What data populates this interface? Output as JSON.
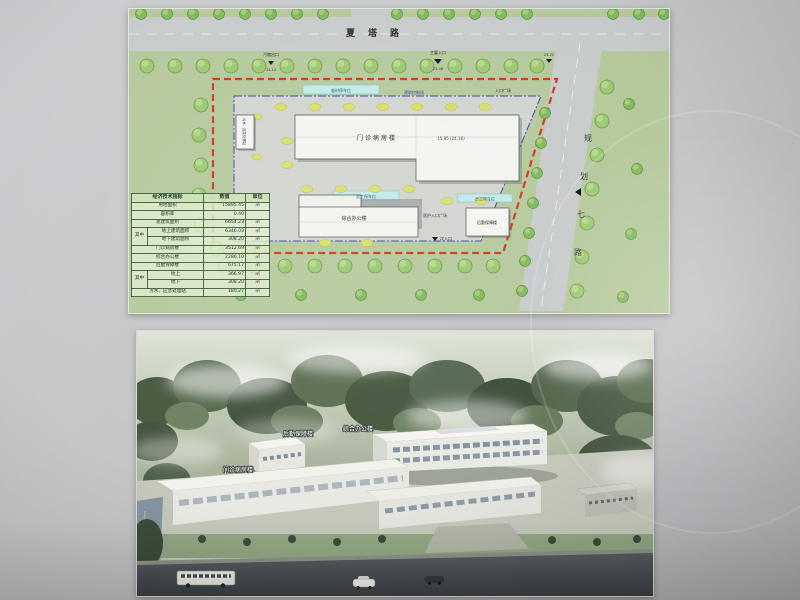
{
  "plan": {
    "road_top": "夏塔路",
    "road_right_chars": [
      "规",
      "划",
      "七",
      "路"
    ],
    "entrances": [
      {
        "label": "污物出口",
        "elev": "23.14"
      },
      {
        "label": "主要入口",
        "elev": "23.46"
      },
      {
        "label": "",
        "elev": "23.22"
      }
    ],
    "labels": {
      "temp_parking": "临时停车位",
      "setback_line": "建筑控制线",
      "entry_plaza": "入口广场",
      "staff_parking": "员工停车位",
      "staff_parking2": "员工停车位",
      "nurse_plaza": "医护入口广场",
      "secondary_entrance": "次入口"
    },
    "buildings": {
      "ward": {
        "name": "门诊病房楼",
        "elev": "15.95 (24.16)"
      },
      "office": {
        "name": "综合办公楼"
      },
      "logistics": {
        "name": "后勤保障楼"
      },
      "sewage": {
        "name": "污水、应急处理站"
      }
    },
    "table": {
      "title": "经济技术指标",
      "col_value": "数值",
      "col_unit": "单位",
      "group_label": "其中",
      "rows": [
        {
          "name": "用地面积",
          "value": "15895.45",
          "unit": "㎡"
        },
        {
          "name": "容积率",
          "value": "0.40",
          "unit": ""
        },
        {
          "name": "总建筑面积",
          "value": "6654.23",
          "unit": "㎡"
        },
        {
          "name": "地上建筑面积",
          "value": "6346.03",
          "unit": "㎡"
        },
        {
          "name": "地下建筑面积",
          "value": "308.20",
          "unit": "㎡"
        },
        {
          "name": "门诊病房楼",
          "value": "3512.69",
          "unit": "㎡"
        },
        {
          "name": "综合办公楼",
          "value": "2286.10",
          "unit": "㎡"
        },
        {
          "name": "后勤保障楼",
          "value": "675.17",
          "unit": "㎡"
        },
        {
          "name": "地上",
          "value": "366.97",
          "unit": "㎡"
        },
        {
          "name": "地下",
          "value": "308.20",
          "unit": "㎡"
        },
        {
          "name": "污水、应急处理站",
          "value": "180.27",
          "unit": "㎡"
        }
      ]
    }
  },
  "rendering": {
    "labels": {
      "office": "综合办公楼",
      "logistics": "后勤保障楼",
      "ward": "门诊病房楼"
    }
  }
}
